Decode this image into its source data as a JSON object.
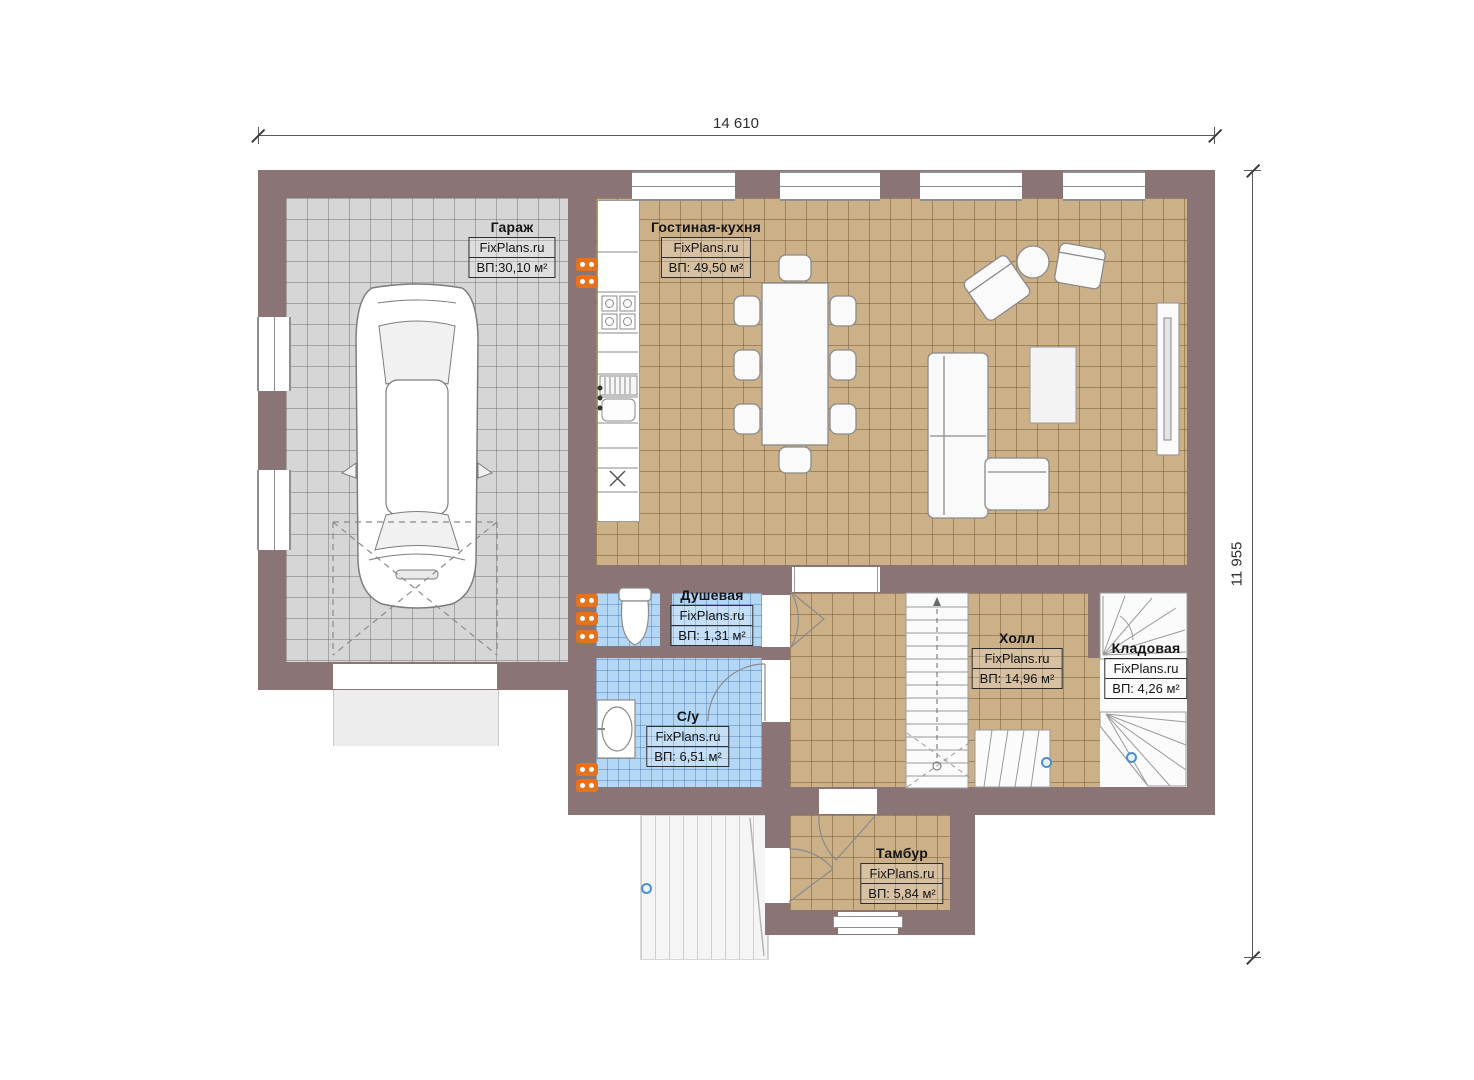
{
  "plan": {
    "type": "floor-plan",
    "dimension_top": "14 610",
    "dimension_right": "11 955",
    "branding": "FixPlans.ru",
    "rooms": [
      {
        "id": "garage",
        "name": "Гараж",
        "site": "FixPlans.ru",
        "area": "ВП:30,10 м²"
      },
      {
        "id": "living-kitchen",
        "name": "Гостиная-кухня",
        "site": "FixPlans.ru",
        "area": "ВП: 49,50 м²"
      },
      {
        "id": "shower",
        "name": "Душевая",
        "site": "FixPlans.ru",
        "area": "ВП: 1,31 м²"
      },
      {
        "id": "wc",
        "name": "С/у",
        "site": "FixPlans.ru",
        "area": "ВП: 6,51 м²"
      },
      {
        "id": "hall",
        "name": "Холл",
        "site": "FixPlans.ru",
        "area": "ВП: 14,96 м²"
      },
      {
        "id": "storage",
        "name": "Кладовая",
        "site": "FixPlans.ru",
        "area": "ВП: 4,26 м²"
      },
      {
        "id": "vestibule",
        "name": "Тамбур",
        "site": "FixPlans.ru",
        "area": "ВП: 5,84 м²"
      }
    ],
    "colors": {
      "wall": "#8a7476",
      "floor_tan": "#ccb088",
      "floor_gray": "#d6d6d6",
      "floor_blue": "#b4d7f5",
      "radiator": "#e5731c"
    }
  }
}
